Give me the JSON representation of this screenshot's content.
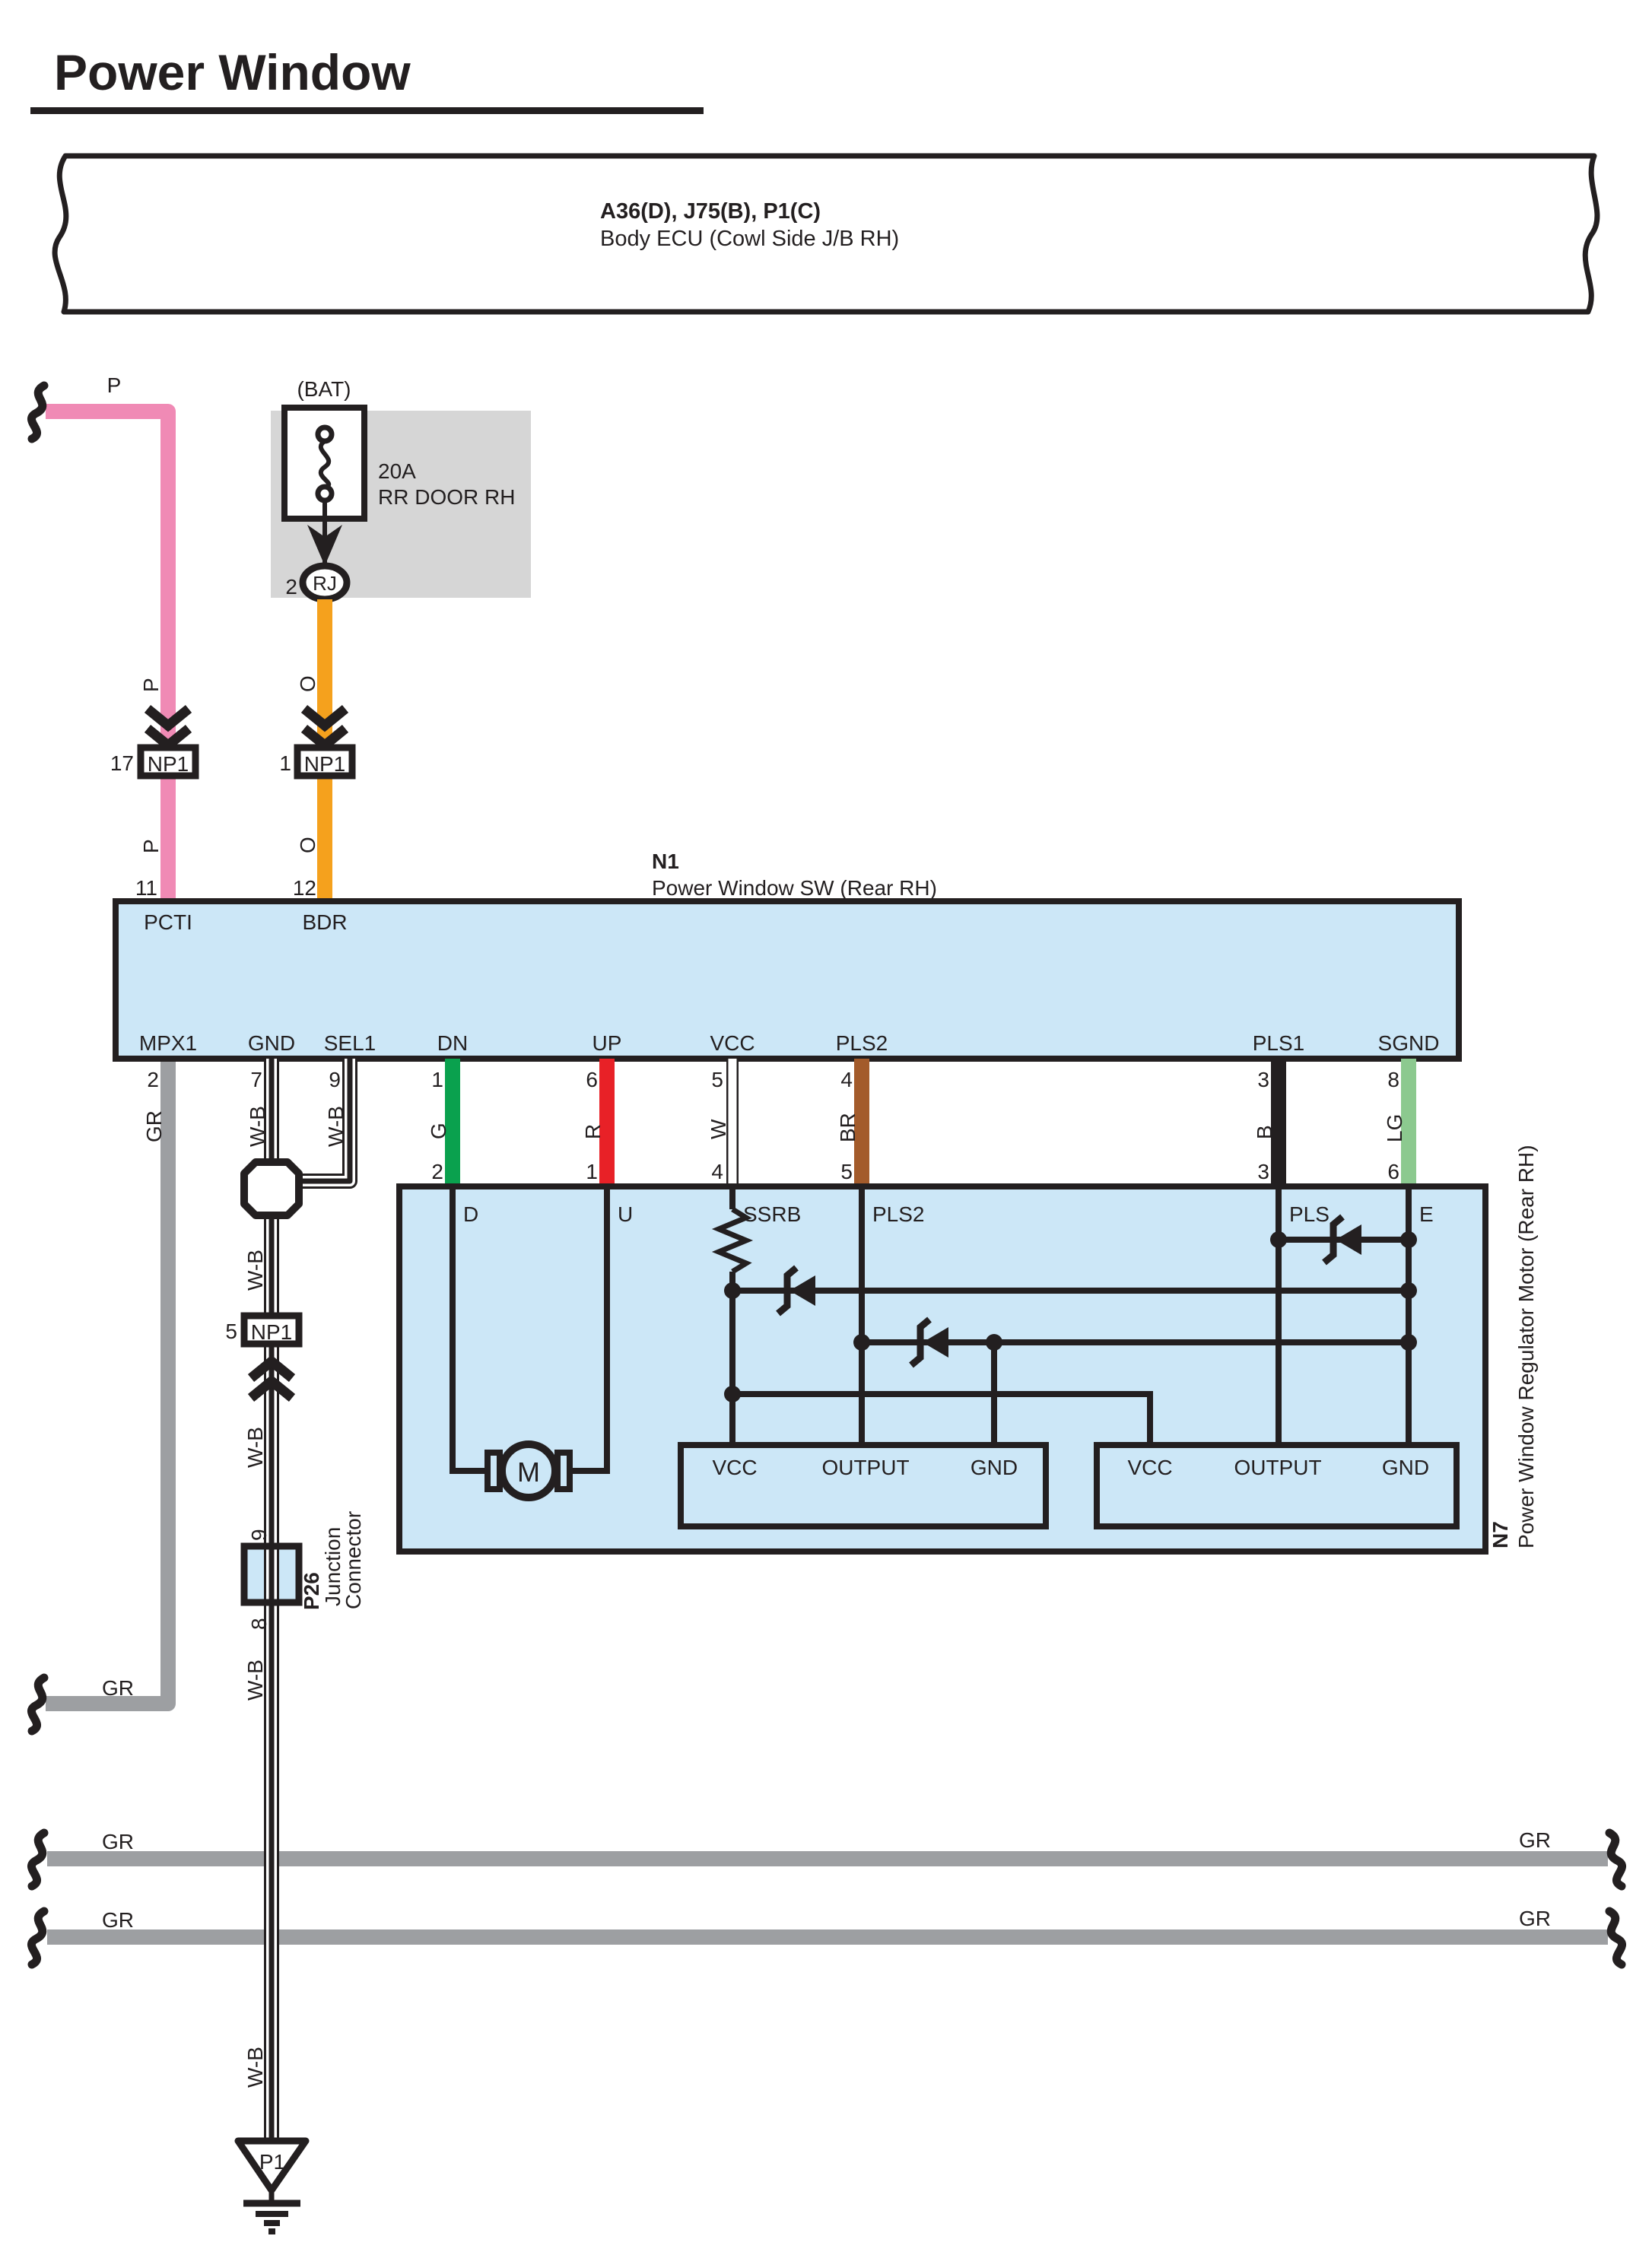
{
  "page": {
    "title": "Power Window"
  },
  "banner": {
    "line1": "A36(D), J75(B), P1(C)",
    "line2": "Body ECU (Cowl Side J/B RH)"
  },
  "fuse": {
    "bat": "(BAT)",
    "rating": "20A",
    "name": "RR DOOR RH",
    "pin": "2",
    "relay": "RJ"
  },
  "codes": {
    "p": "P",
    "o": "O"
  },
  "np1_left": {
    "pin": "17",
    "label": "NP1"
  },
  "np1_right": {
    "pin": "1",
    "label": "NP1"
  },
  "np1_mid": {
    "pin": "5",
    "label": "NP1"
  },
  "p26": {
    "id": "P26",
    "line1": "Junction",
    "line2": "Connector",
    "pin_top": "9",
    "pin_bottom": "8"
  },
  "n1": {
    "id": "N1",
    "name": "Power Window SW (Rear RH)",
    "pin11": "11",
    "pin12": "12",
    "pcti": "PCTI",
    "bdr": "BDR",
    "bottom": [
      {
        "label": "MPX1",
        "pin": "2",
        "code": "GR"
      },
      {
        "label": "GND",
        "pin": "7",
        "code": "W-B"
      },
      {
        "label": "SEL1",
        "pin": "9",
        "code": "W-B"
      },
      {
        "label": "DN",
        "pin": "1",
        "code": "G"
      },
      {
        "label": "UP",
        "pin": "6",
        "code": "R"
      },
      {
        "label": "VCC",
        "pin": "5",
        "code": "W"
      },
      {
        "label": "PLS2",
        "pin": "4",
        "code": "BR"
      },
      {
        "label": "PLS1",
        "pin": "3",
        "code": "B"
      },
      {
        "label": "SGND",
        "pin": "8",
        "code": "LG"
      }
    ]
  },
  "n7": {
    "id": "N7",
    "name": "Power Window Regulator Motor (Rear RH)",
    "motor": "M",
    "pins": [
      {
        "label": "D",
        "pin": "2"
      },
      {
        "label": "U",
        "pin": "1"
      },
      {
        "label": "SSRB",
        "pin": "4"
      },
      {
        "label": "PLS2",
        "pin": "5"
      },
      {
        "label": "PLS",
        "pin": "3"
      },
      {
        "label": "E",
        "pin": "6"
      }
    ],
    "left_block": [
      "VCC",
      "OUTPUT",
      "GND"
    ],
    "right_block": [
      "VCC",
      "OUTPUT",
      "GND"
    ]
  },
  "labels": {
    "gr": "GR",
    "wb": "W-B"
  },
  "ground": {
    "id": "P1"
  },
  "colors": {
    "panel_blue": "#cce7f7",
    "panel_gray": "#d6d6d6",
    "pink": "#f08ab5",
    "orange": "#f5a11d",
    "green": "#0aa14e",
    "red": "#e82127",
    "brown": "#a35b2b",
    "black_wire": "#231f20",
    "light_green": "#8cc98f",
    "gray_wire": "#9d9fa2"
  }
}
